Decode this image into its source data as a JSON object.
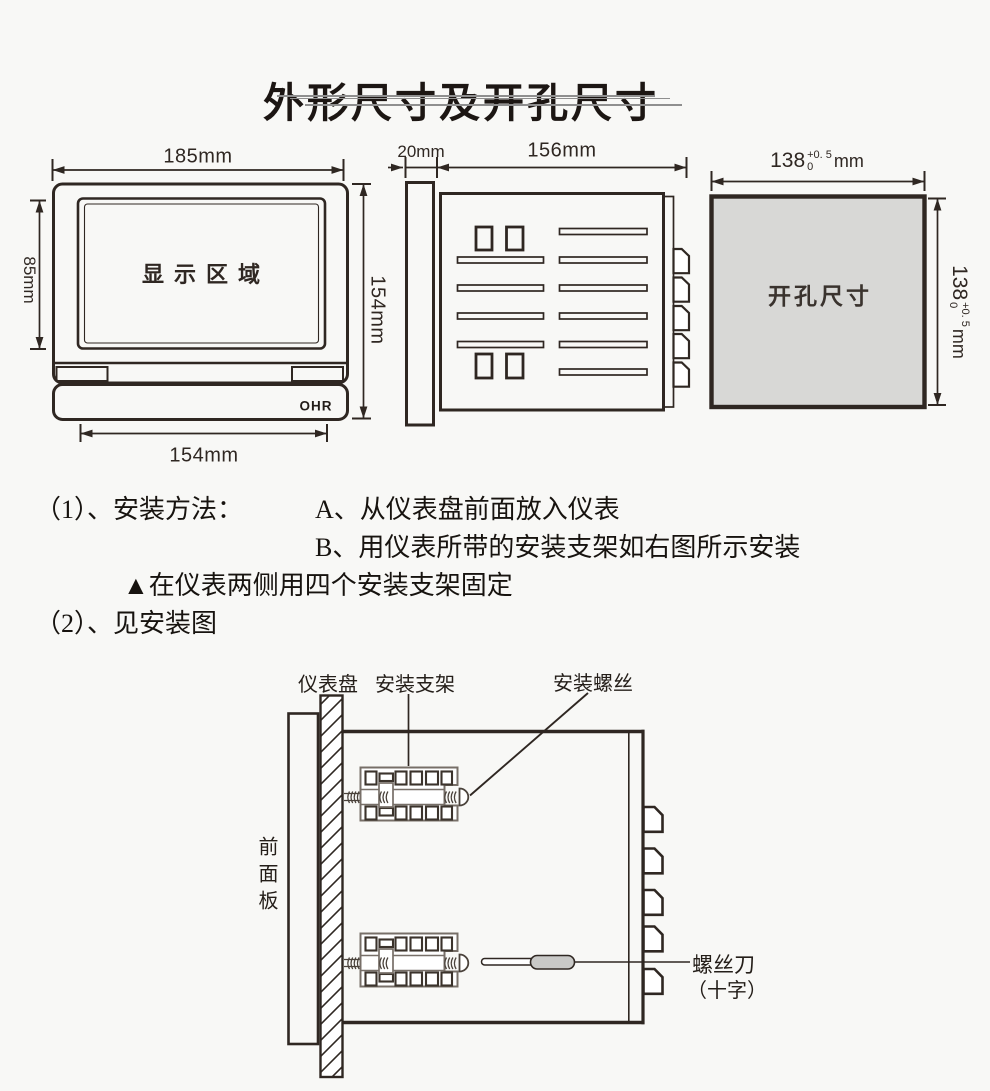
{
  "page": {
    "title": "外形尺寸及开孔尺寸"
  },
  "front_view": {
    "width_label": "185mm",
    "display_height_label": "85mm",
    "height_label": "154mm",
    "bottom_width_label": "154mm",
    "display_area_label": "显示区域",
    "brand_logo": "OHR"
  },
  "side_view": {
    "bezel_depth_label": "20mm",
    "body_depth_label": "156mm"
  },
  "cutout_view": {
    "area_label": "开孔尺寸",
    "dim_value": "138",
    "dim_tol_sup": "+0. 5",
    "dim_tol_sub": "0",
    "dim_unit": "mm"
  },
  "instructions": {
    "line1_prefix": "（1）、安装方法：",
    "line1_step": "A、从仪表盘前面放入仪表",
    "line2_step": "B、用仪表所带的安装支架如右图所示安装",
    "note": "▲在仪表两侧用四个安装支架固定",
    "line4": "（2）、见安装图"
  },
  "install_diagram": {
    "panel_label": "仪表盘",
    "bracket_label": "安装支架",
    "screw_label": "安装螺丝",
    "front_panel_label": "前面板",
    "screwdriver_label": "螺丝刀",
    "screwdriver_type_label": "（十字）"
  }
}
